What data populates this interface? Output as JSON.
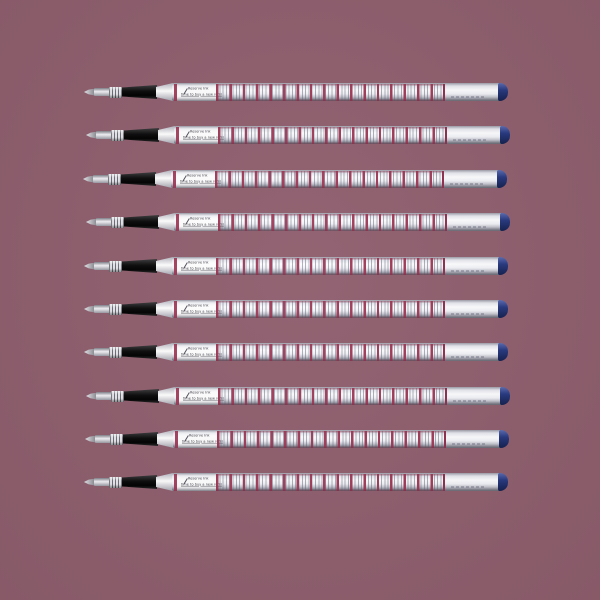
{
  "scene": {
    "description": "Product photo: ten identical rollerball ink refills stacked vertically on a plain mauve background",
    "background_color": "#8f5f6e",
    "item_count": 10
  },
  "pen": {
    "label_line1": "Reserve Ink",
    "label_line2": "time to buy a new refill",
    "nib_icon": "pen-nib-slash",
    "colors": {
      "barrel_silver": "#f0f1f6",
      "stripe_red": "#9c3352",
      "stripe_thin_gray": "#64647a",
      "grip_black": "#0b0b0c",
      "end_cap_blue": "#27387f",
      "tip_metal": "#b8b8c0"
    }
  },
  "pens": {
    "count": 10,
    "positions": [
      {
        "x": 84,
        "y": 83
      },
      {
        "x": 86,
        "y": 126
      },
      {
        "x": 83,
        "y": 170
      },
      {
        "x": 86,
        "y": 213
      },
      {
        "x": 84,
        "y": 257
      },
      {
        "x": 84,
        "y": 300
      },
      {
        "x": 84,
        "y": 343
      },
      {
        "x": 86,
        "y": 387
      },
      {
        "x": 85,
        "y": 430
      },
      {
        "x": 84,
        "y": 473
      }
    ]
  }
}
